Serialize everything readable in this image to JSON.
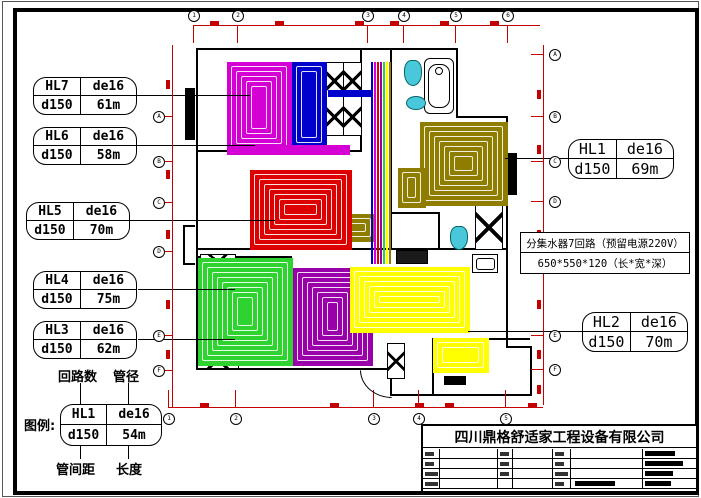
{
  "colors": {
    "dim_red": "#c40000",
    "magenta": "#d400d4",
    "blue": "#0000cc",
    "olive": "#8f7d00",
    "red": "#dd0000",
    "green": "#2fd32f",
    "purple": "#9900aa",
    "yellow": "#ffff00",
    "cyan_fixture": "#49c8dc"
  },
  "labels_left": [
    {
      "circuit": "HL7",
      "pipe": "de16",
      "spacing": "d150",
      "length": "61m"
    },
    {
      "circuit": "HL6",
      "pipe": "de16",
      "spacing": "d150",
      "length": "58m"
    },
    {
      "circuit": "HL5",
      "pipe": "de16",
      "spacing": "d150",
      "length": "70m"
    },
    {
      "circuit": "HL4",
      "pipe": "de16",
      "spacing": "d150",
      "length": "75m"
    },
    {
      "circuit": "HL3",
      "pipe": "de16",
      "spacing": "d150",
      "length": "62m"
    }
  ],
  "labels_right": [
    {
      "circuit": "HL1",
      "pipe": "de16",
      "spacing": "d150",
      "length": "69m"
    },
    {
      "circuit": "HL2",
      "pipe": "de16",
      "spacing": "d150",
      "length": "70m"
    }
  ],
  "manifold_note": {
    "line1": "分集水器7回路（预留电源220V）",
    "line2": "650*550*120（长*宽*深）"
  },
  "legend": {
    "prefix": "图例:",
    "circuit": "HL1",
    "pipe": "de16",
    "spacing": "d150",
    "length": "54m",
    "label_top_left": "回路数",
    "label_top_right": "管径",
    "label_bottom_left": "管间距",
    "label_bottom_right": "长度"
  },
  "title_block": {
    "company": "四川鼎格舒适家工程设备有限公司"
  },
  "plan": {
    "loops": [
      {
        "name": "HL7-loop",
        "color": "#d400d4",
        "x": 227,
        "y": 62,
        "w": 63,
        "h": 90
      },
      {
        "name": "bath-blue-loop",
        "color": "#0000cc",
        "x": 292,
        "y": 62,
        "w": 33,
        "h": 84
      },
      {
        "name": "HL7-return-strip",
        "color": "#d400d4",
        "x": 227,
        "y": 145,
        "w": 121,
        "h": 8
      },
      {
        "name": "HL1-loop",
        "color": "#8f7d00",
        "x": 420,
        "y": 122,
        "w": 86,
        "h": 82
      },
      {
        "name": "HL1-branch",
        "color": "#8f7d00",
        "x": 398,
        "y": 168,
        "w": 26,
        "h": 38
      },
      {
        "name": "HL1-corridor",
        "color": "#8f7d00",
        "x": 332,
        "y": 214,
        "w": 42,
        "h": 26
      },
      {
        "name": "HL5-loop",
        "color": "#dd0000",
        "x": 250,
        "y": 170,
        "w": 100,
        "h": 78
      },
      {
        "name": "HL3-loop",
        "color": "#2fd32f",
        "x": 198,
        "y": 258,
        "w": 93,
        "h": 106
      },
      {
        "name": "HL4-loop",
        "color": "#9900aa",
        "x": 293,
        "y": 268,
        "w": 78,
        "h": 96
      },
      {
        "name": "HL2-loop",
        "color": "#ffff00",
        "x": 350,
        "y": 267,
        "w": 118,
        "h": 64
      },
      {
        "name": "HL2-kitchen-loop",
        "color": "#ffff00",
        "x": 433,
        "y": 338,
        "w": 54,
        "h": 33
      }
    ],
    "pipe_bundle": {
      "x": 371,
      "y": 62,
      "h": 202,
      "step": 3,
      "colors": [
        "#0000cc",
        "#d400d4",
        "#dd0000",
        "#9900aa",
        "#2fd32f",
        "#ffff00",
        "#8f7d00"
      ]
    },
    "walls": [
      [
        196,
        48,
        262,
        2
      ],
      [
        196,
        48,
        2,
        322
      ],
      [
        196,
        368,
        196,
        2
      ],
      [
        456,
        48,
        2,
        70
      ],
      [
        456,
        116,
        52,
        2
      ],
      [
        506,
        116,
        2,
        232
      ],
      [
        506,
        346,
        26,
        2
      ],
      [
        530,
        346,
        2,
        50
      ],
      [
        390,
        394,
        142,
        2
      ],
      [
        390,
        368,
        2,
        28
      ],
      [
        196,
        150,
        166,
        2
      ],
      [
        196,
        248,
        312,
        2
      ],
      [
        360,
        48,
        2,
        104
      ],
      [
        390,
        48,
        2,
        202
      ],
      [
        392,
        212,
        48,
        2
      ],
      [
        438,
        212,
        2,
        38
      ],
      [
        196,
        256,
        96,
        2
      ],
      [
        432,
        338,
        98,
        2
      ],
      [
        432,
        338,
        2,
        58
      ],
      [
        185,
        88,
        10,
        52
      ],
      [
        507,
        153,
        10,
        42
      ],
      [
        183,
        225,
        2,
        40
      ],
      [
        183,
        225,
        12,
        2
      ],
      [
        183,
        263,
        12,
        2
      ]
    ],
    "xboxes": [
      {
        "x": 325,
        "y": 62,
        "w": 17,
        "h": 72,
        "cells": 2
      },
      {
        "x": 343,
        "y": 62,
        "w": 17,
        "h": 72,
        "cells": 2
      },
      {
        "x": 200,
        "y": 254,
        "w": 34,
        "h": 16,
        "cells": 1
      },
      {
        "x": 197,
        "y": 349,
        "w": 40,
        "h": 18,
        "cells": 1
      },
      {
        "x": 475,
        "y": 205,
        "w": 26,
        "h": 43,
        "cells": 1
      },
      {
        "x": 387,
        "y": 343,
        "w": 16,
        "h": 34,
        "cells": 1
      }
    ],
    "leaders": [
      [
        135,
        95,
        115
      ],
      [
        135,
        145,
        120
      ],
      [
        125,
        220,
        150
      ],
      [
        138,
        289,
        97
      ],
      [
        138,
        339,
        97
      ],
      [
        505,
        158,
        63
      ],
      [
        468,
        331,
        114
      ]
    ],
    "legend_connectors": [
      [
        80,
        383,
        21
      ],
      [
        128,
        383,
        21
      ],
      [
        80,
        444,
        15
      ],
      [
        128,
        444,
        15
      ]
    ]
  },
  "axes": {
    "top": {
      "labels": [
        "1",
        "2",
        "3",
        "4",
        "5",
        "6"
      ],
      "xs": [
        193,
        237,
        367,
        403,
        455,
        507
      ],
      "y": 15
    },
    "bottom": {
      "labels": [
        "1",
        "2",
        "3",
        "4",
        "5"
      ],
      "xs": [
        168,
        235,
        373,
        418,
        505
      ],
      "y": 413
    },
    "left": {
      "labels": [
        "A",
        "B",
        "C",
        "D",
        "E",
        "F"
      ],
      "ys": [
        116,
        161,
        202,
        251,
        335,
        370
      ],
      "x": 153
    },
    "right": {
      "labels": [
        "A",
        "B",
        "C",
        "D",
        "E",
        "F"
      ],
      "ys": [
        54,
        116,
        161,
        201,
        335,
        369
      ],
      "x": 549
    }
  },
  "dim_marks": {
    "top_y": 21,
    "top_xs": [
      210,
      275,
      355,
      390,
      440,
      490
    ],
    "bottom_y": 403,
    "bottom_xs": [
      200,
      330,
      415,
      445,
      528
    ],
    "left_x": 166,
    "left_ys": [
      80,
      170,
      230,
      300,
      350
    ],
    "right_x": 537,
    "right_ys": [
      90,
      145,
      230,
      300,
      350,
      385
    ]
  }
}
